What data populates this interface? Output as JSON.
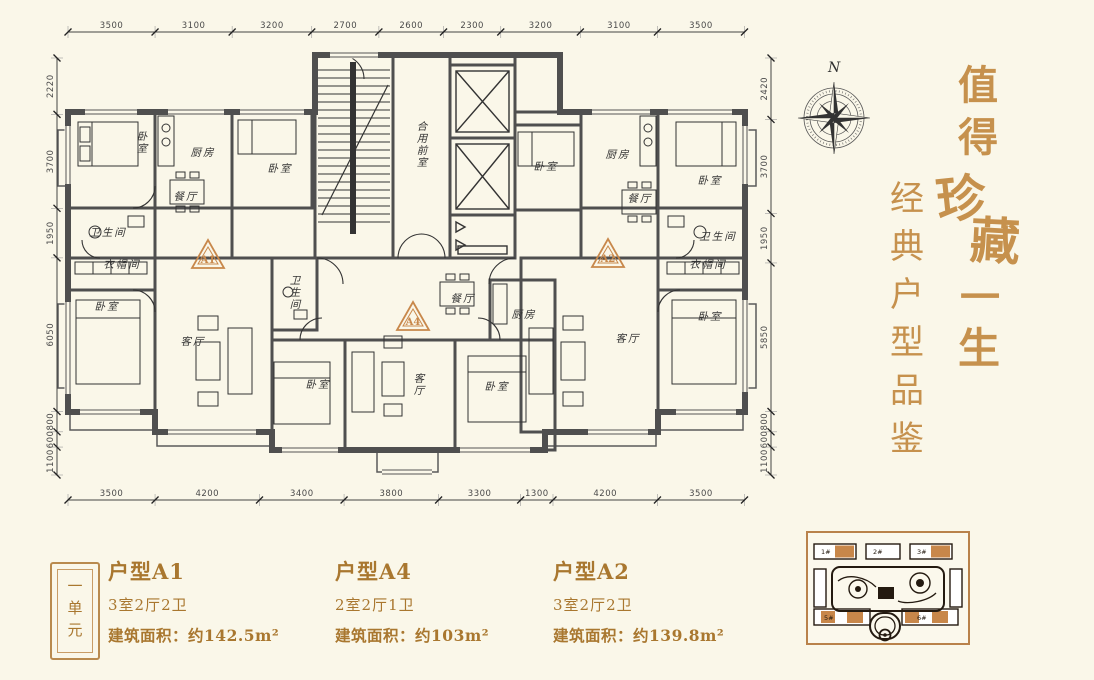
{
  "colors": {
    "background": "#faf7e9",
    "wall": "#4f4f4f",
    "gold": "#a9772f",
    "calligraphy_gold": "#c6914d",
    "accent_orange": "#c8884b",
    "site_highlight": "#c8874a"
  },
  "plan": {
    "dims": {
      "top": [
        "3500",
        "3100",
        "3200",
        "2700",
        "2600",
        "2300",
        "3200",
        "3100",
        "3500"
      ],
      "bottom": [
        "3500",
        "4200",
        "3400",
        "3800",
        "3300",
        "1300",
        "4200",
        "3500"
      ],
      "left": [
        "2220",
        "3700",
        "1950",
        "6050",
        "800",
        "600",
        "1100"
      ],
      "right": [
        "2420",
        "3700",
        "1950",
        "5850",
        "800",
        "600",
        "1100"
      ]
    },
    "room_labels": [
      {
        "id": "a1-bedroom-1",
        "text": "卧室"
      },
      {
        "id": "a1-kitchen",
        "text": "厨房"
      },
      {
        "id": "a1-bedroom-2",
        "text": "卧室"
      },
      {
        "id": "a1-dining",
        "text": "餐厅"
      },
      {
        "id": "a1-bath",
        "text": "卫生间"
      },
      {
        "id": "a1-cloak",
        "text": "衣帽间"
      },
      {
        "id": "a1-bedroom-3",
        "text": "卧室"
      },
      {
        "id": "a1-living",
        "text": "客厅"
      },
      {
        "id": "core-lobby",
        "text": "合用前室"
      },
      {
        "id": "a4-bath",
        "text": "卫生间"
      },
      {
        "id": "a4-bedroom-1",
        "text": "卧室"
      },
      {
        "id": "a4-living",
        "text": "客厅"
      },
      {
        "id": "a4-dining",
        "text": "餐厅"
      },
      {
        "id": "a4-kitchen",
        "text": "厨房"
      },
      {
        "id": "a4-bedroom-2",
        "text": "卧室"
      },
      {
        "id": "a2-bedroom-1",
        "text": "卧室"
      },
      {
        "id": "a2-kitchen",
        "text": "厨房"
      },
      {
        "id": "a2-dining",
        "text": "餐厅"
      },
      {
        "id": "a2-bedroom-2",
        "text": "卧室"
      },
      {
        "id": "a2-bath",
        "text": "卫生间"
      },
      {
        "id": "a2-cloak",
        "text": "衣帽间"
      },
      {
        "id": "a2-living",
        "text": "客厅"
      },
      {
        "id": "a2-bedroom-3",
        "text": "卧室"
      }
    ],
    "badges": [
      {
        "id": "a1",
        "label": "A1"
      },
      {
        "id": "a4",
        "label": "A4"
      },
      {
        "id": "a2",
        "label": "A2"
      }
    ]
  },
  "compass": {
    "north_label": "N"
  },
  "calligraphy": {
    "main": "值得珍藏一生",
    "sub": "经典户型品鉴"
  },
  "legend": {
    "unit_box": "一单元",
    "units": [
      {
        "name": "户型A1",
        "rooms": "3室2厅2卫",
        "area": "建筑面积：约142.5m²"
      },
      {
        "name": "户型A4",
        "rooms": "2室2厅1卫",
        "area": "建筑面积：约103m²"
      },
      {
        "name": "户型A2",
        "rooms": "3室2厅2卫",
        "area": "建筑面积：约139.8m²"
      }
    ]
  },
  "site_plan": {
    "buildings": [
      "1#",
      "2#",
      "3#",
      "5#",
      "6#"
    ]
  }
}
